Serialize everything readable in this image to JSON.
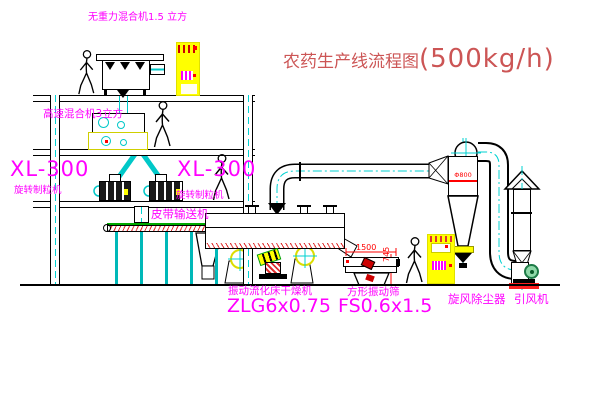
{
  "title": {
    "text": "农药生产线流程图",
    "capacity": "(500kg/h)"
  },
  "labels": {
    "top_mixer": "无重力混合机1.5 立方",
    "high_speed_mixer": "高速混合机3立方",
    "granulator_left_model": "XL-300",
    "granulator_left_name": "旋转制粒机",
    "granulator_right_model": "XL-300",
    "granulator_right_name": "旋转制粒机",
    "belt_conveyor": "皮带输送机",
    "dryer_name": "振动流化床干燥机",
    "dryer_model": "ZLG6x0.75",
    "sieve_name": "方形振动筛",
    "sieve_model": "FS0.6x1.5",
    "cyclone": "旋风除尘器",
    "fan": "引风机"
  },
  "dimensions": {
    "sieve_length": "1500",
    "sieve_height": "745",
    "cyclone_diameter": "Φ800"
  },
  "colors": {
    "label_magenta": "#ff00ff",
    "title_red": "#cc5555",
    "dimension_red": "#ff0000",
    "centerline_cyan": "#00d2d2",
    "cabinet_yellow": "#ffff00",
    "fan_green": "#2e9e5b",
    "belt_green": "#00aa00"
  }
}
